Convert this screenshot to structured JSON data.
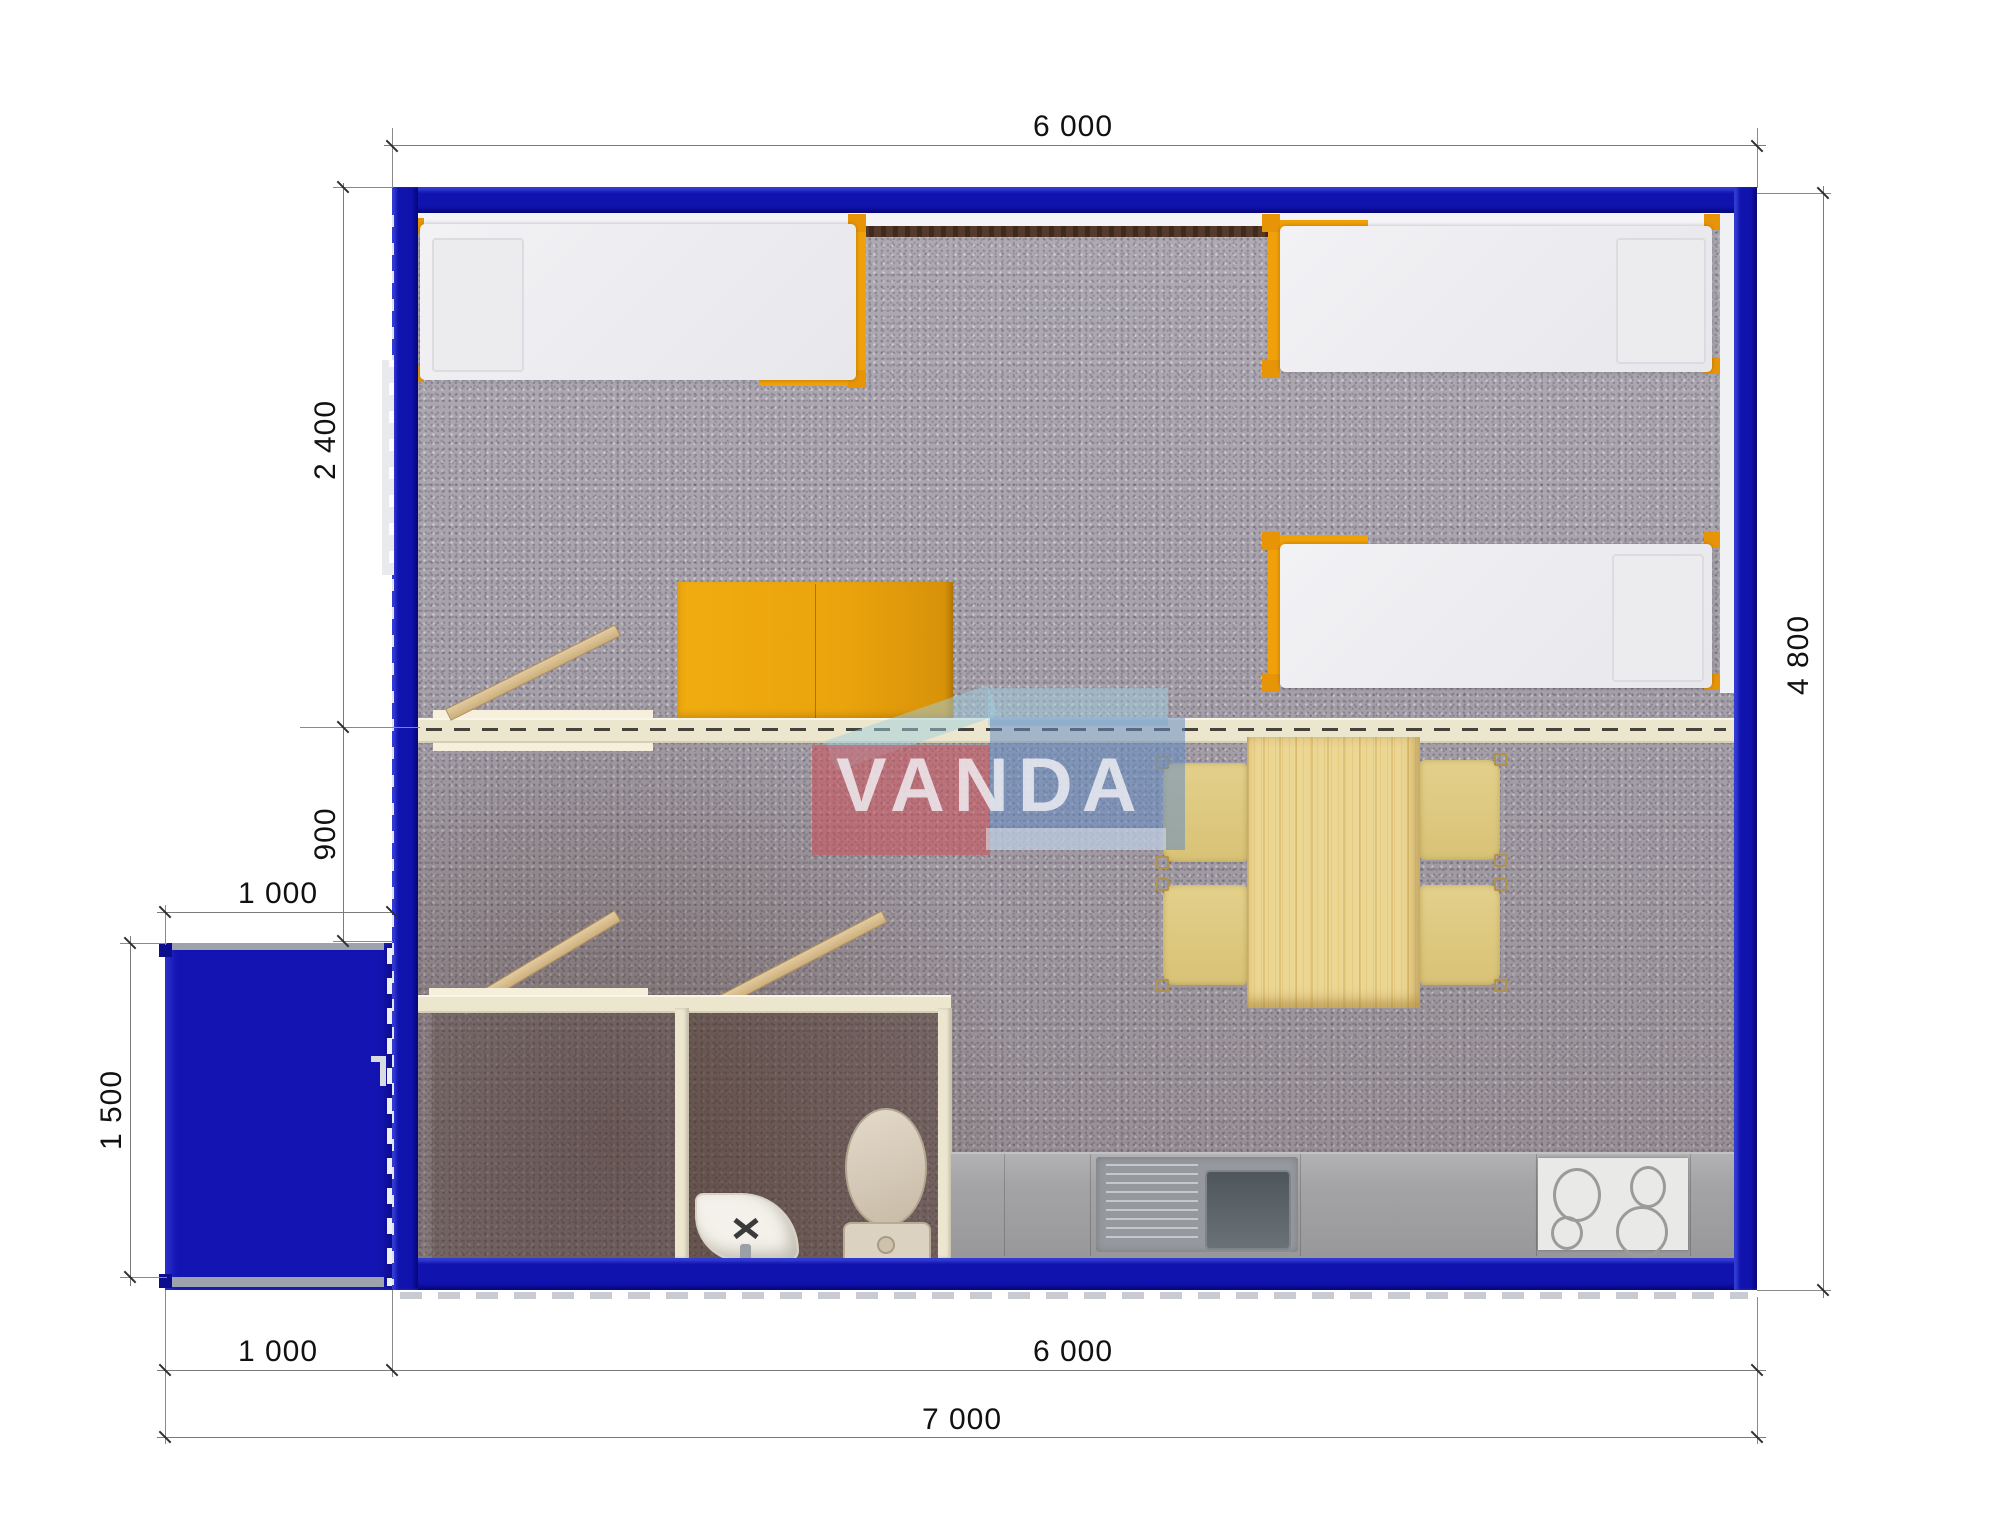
{
  "title": "Modular cabin floor plan render",
  "watermark": {
    "brand": "VANDA"
  },
  "dimensions": {
    "top_width": "6 000",
    "side_height": "4 800",
    "bedroom_depth": "2 400",
    "hall_depth": "900",
    "porch_width": "1 000",
    "porch_depth": "1 500",
    "bottom_porch_width": "1 000",
    "bottom_main_width": "6 000",
    "bottom_total_width": "7 000"
  },
  "colors": {
    "frame_blue": "#1113AF",
    "porch_blue": "#1414B2",
    "furniture_orange": "#F0A009",
    "wardrobe_orange": "#EDA90E",
    "wall_cream": "#EDE6CF",
    "floor_gray": "#A8A3AD",
    "table_wood": "#EAD491",
    "chair_tan": "#DFCB80",
    "counter_gray": "#A6A6A8",
    "watermark_red": "#C8505A",
    "watermark_blue": "#6489BE"
  },
  "items": {
    "beds": "single-bed",
    "wardrobe": "wardrobe",
    "table": "dining-table",
    "chair": "chair",
    "counter": "kitchen-counter",
    "kitchen_sink": "kitchen-sink",
    "cooktop": "cooktop",
    "toilet": "toilet",
    "washbasin": "corner-washbasin",
    "porch": "entrance-porch"
  }
}
